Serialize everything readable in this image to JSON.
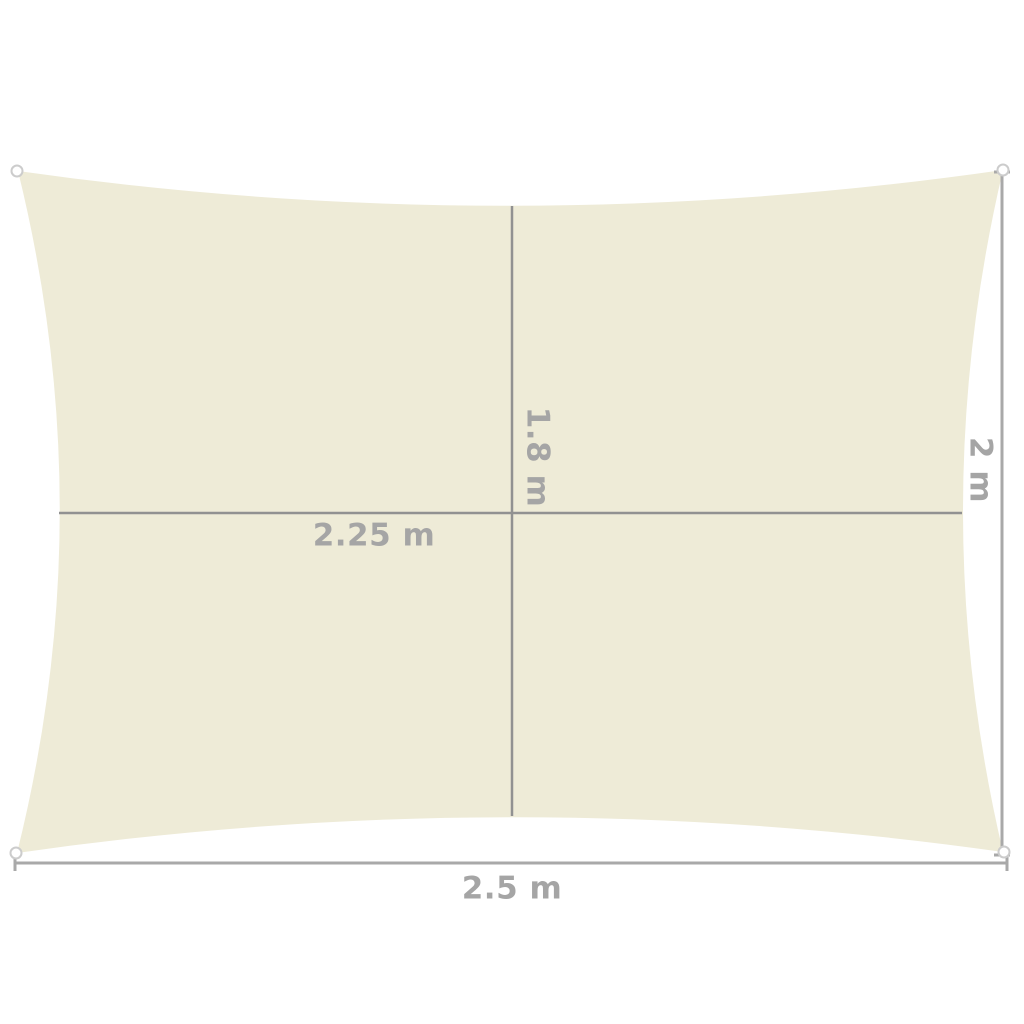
{
  "measurements": {
    "inner_width": "2.25 m",
    "inner_height": "1.8 m",
    "outer_width": "2.5 m",
    "outer_height": "2 m"
  },
  "colors": {
    "background": "#ffffff",
    "sail_fill": "#eeebd7",
    "inner_line": "#919191",
    "dimension_line": "#a9a9a9",
    "ring_stroke": "#cccccc",
    "label_text": "#a5a5a5"
  }
}
